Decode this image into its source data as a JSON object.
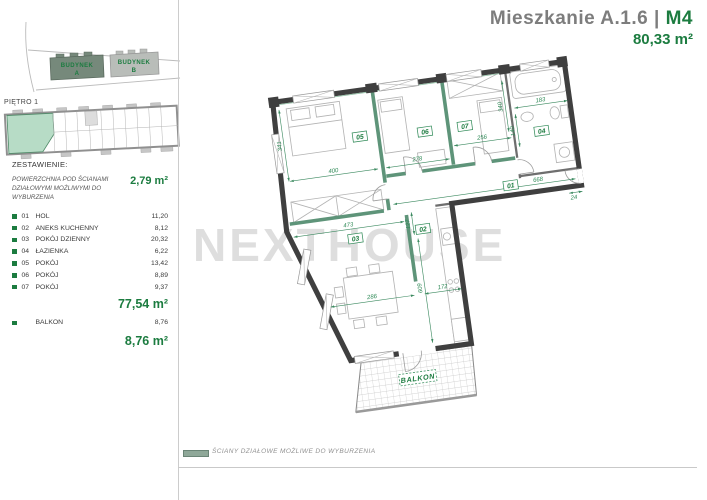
{
  "header": {
    "title": "Mieszkanie  A.1.6",
    "separator": "| ",
    "unit": "M4",
    "area": "80,33 m²"
  },
  "colors": {
    "accent_green": "#1c7c40",
    "wall_dark": "#3f3f3f",
    "partition_green": "#5e9479",
    "highlight_teal": "#b7dcc6",
    "watermark_gray": "#dedede"
  },
  "siteplan": {
    "building_a_line1": "BUDYNEK",
    "building_a_line2": "A",
    "building_b_line1": "BUDYNEK",
    "building_b_line2": "B"
  },
  "overview": {
    "floor_label": "PIĘTRO 1"
  },
  "legend": {
    "title": "ZESTAWIENIE:",
    "note": "POWIERZCHNIA POD ŚCIANAMI DZIAŁOWYMI MOŻLIWYMI DO WYBURZENIA",
    "note_value": "2,79 m²",
    "rooms": [
      {
        "no": "01",
        "name": "HOL",
        "area": "11,20"
      },
      {
        "no": "02",
        "name": "ANEKS KUCHENNY",
        "area": "8,12"
      },
      {
        "no": "03",
        "name": "POKÓJ DZIENNY",
        "area": "20,32"
      },
      {
        "no": "04",
        "name": "ŁAZIENKA",
        "area": "6,22"
      },
      {
        "no": "05",
        "name": "POKÓJ",
        "area": "13,42"
      },
      {
        "no": "06",
        "name": "POKÓJ",
        "area": "8,89"
      },
      {
        "no": "07",
        "name": "POKÓJ",
        "area": "9,37"
      }
    ],
    "rooms_total": "77,54 m²",
    "balkon_name": "BALKON",
    "balkon_area": "8,76",
    "balkon_total": "8,76 m²"
  },
  "plan": {
    "watermark": "NEXTHOUSE",
    "balcony_label": "BALKON",
    "rooms": {
      "r01": "01",
      "r02": "02",
      "r03": "03",
      "r04": "04",
      "r05": "05",
      "r06": "06",
      "r07": "07"
    },
    "dims": {
      "d400": "400",
      "d341": "341",
      "d278": "278",
      "d256": "256",
      "d340": "340",
      "d183": "183",
      "d140": "140",
      "d668": "668",
      "d24": "24",
      "d473": "473",
      "d127": "127",
      "d286": "286",
      "d172": "172",
      "d609": "609"
    }
  },
  "footer": {
    "legend_text": "ŚCIANY DZIAŁOWE MOŻLIWE DO WYBURZENIA"
  }
}
